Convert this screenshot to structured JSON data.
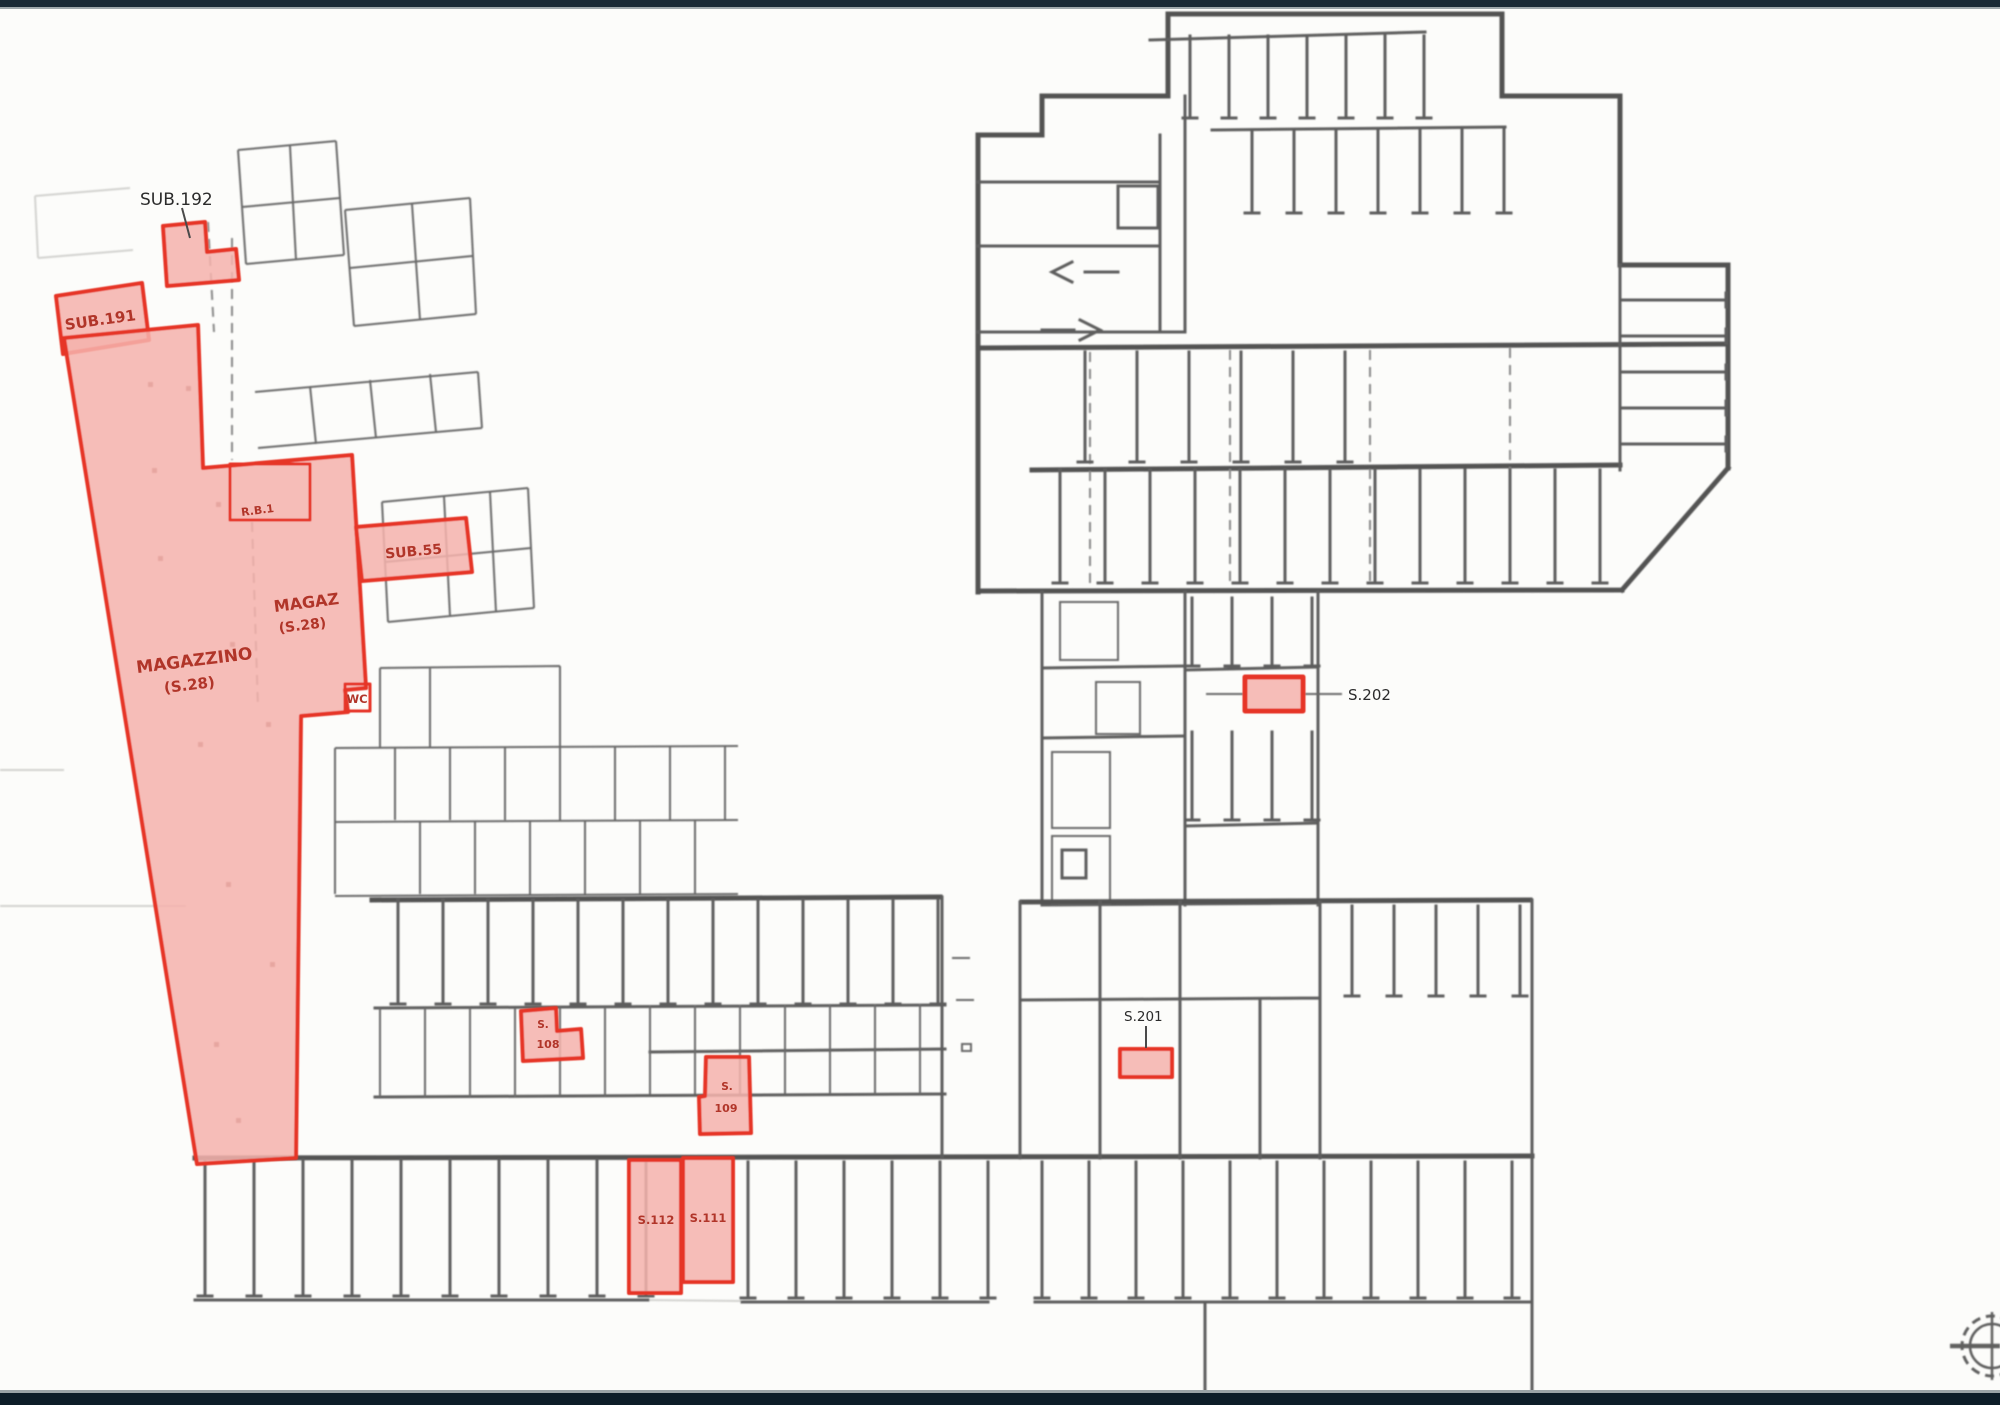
{
  "page": {
    "background": "#fcfcfa",
    "top_bar_color": "#1a2a35",
    "bottom_bar_color": "#0d1d28"
  },
  "plan": {
    "colors": {
      "highlight_fill": "#f6b3ad",
      "highlight_stroke": "#e63528",
      "red_label": "#b13529",
      "black_label": "#2b2b2b",
      "line": "#3a3a3a"
    },
    "units": {
      "sub192": {
        "label": "SUB.192"
      },
      "sub191": {
        "label": "SUB.191"
      },
      "magazzino": {
        "name": "MAGAZZINO",
        "area": "(S.28)"
      },
      "magaz": {
        "name": "MAGAZ",
        "area": "(S.28)"
      },
      "rb1": {
        "label": "R.B.1"
      },
      "sub55": {
        "label": "SUB.55"
      },
      "wc": {
        "label": "WC"
      },
      "s202": {
        "label": "S.202"
      },
      "s201": {
        "label": "S.201"
      },
      "s108": {
        "line1": "S.",
        "line2": "108"
      },
      "s109": {
        "line1": "S.",
        "line2": "109"
      },
      "s112": {
        "label": "S.112"
      },
      "s111": {
        "label": "S.111"
      }
    },
    "icons": {
      "north_indicator": "crosshair-compass"
    }
  }
}
